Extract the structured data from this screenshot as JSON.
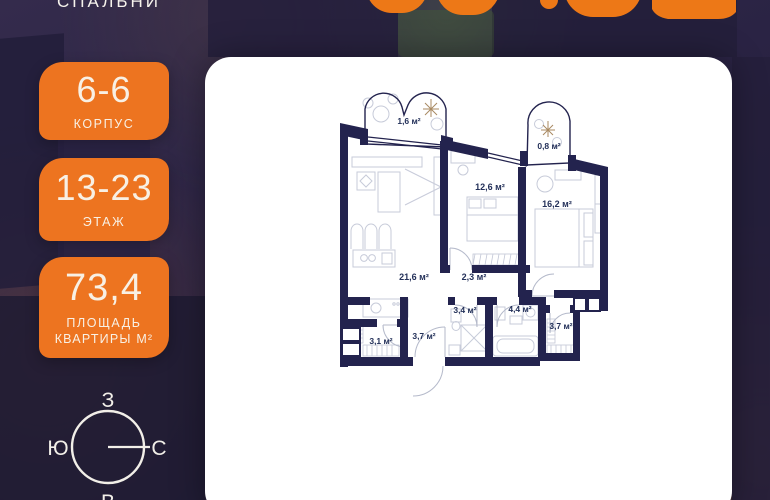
{
  "header": {
    "bedrooms_label": "СПАЛЬНИ"
  },
  "badges": [
    {
      "value": "6-6",
      "label": "КОРПУС"
    },
    {
      "value": "13-23",
      "label": "ЭТАЖ"
    },
    {
      "value": "73,4",
      "label_line1": "ПЛОЩАДЬ",
      "label_line2": "КВАРТИРЫ М²"
    }
  ],
  "compass": {
    "top": "З",
    "left": "Ю",
    "right": "С",
    "bottom": "В"
  },
  "plan": {
    "rooms": {
      "balcony_small": {
        "area": "1,6 м²"
      },
      "balcony_tiny": {
        "area": "0,8 м²"
      },
      "bedroom": {
        "area": "12,6 м²"
      },
      "master_bedroom": {
        "area": "16,2 м²"
      },
      "living_kitchen": {
        "area": "21,6 м²"
      },
      "hall": {
        "area": "2,3 м²"
      },
      "shower_room": {
        "area": "3,4 м²"
      },
      "bathroom": {
        "area": "4,4 м²"
      },
      "wardrobe": {
        "area": "3,7 м²"
      },
      "laundry": {
        "area": "3,1 м²"
      },
      "hallway": {
        "area": "3,7 м²"
      }
    }
  },
  "colors": {
    "accent_orange": "#ED7420",
    "wall_navy": "#23234E",
    "card_white": "#FFFFFF",
    "background_dark": "#2A2344",
    "label_navy": "#233059"
  }
}
